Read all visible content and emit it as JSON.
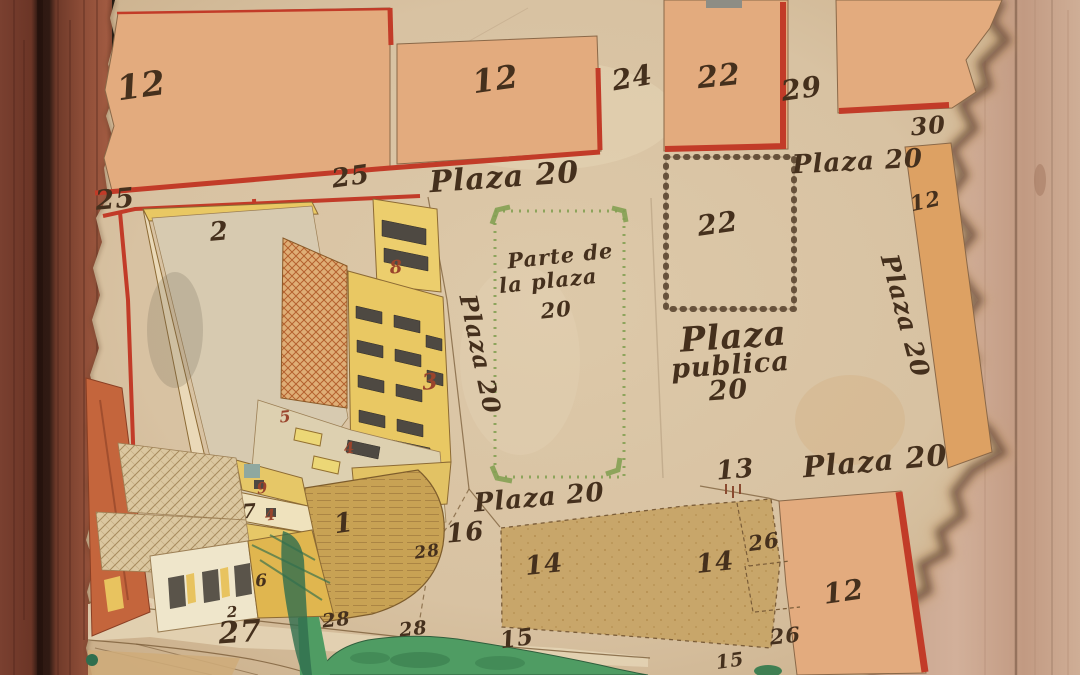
{
  "map": {
    "description_labels_note": "hand-drawn town plat on torn parchment",
    "plaza_block_names": [
      "Plaza 20",
      "Plaza publica 20",
      "Parte de la plaza 20"
    ]
  },
  "palette": {
    "parchment": "#d8c2a2",
    "parchment_light": "#e6d5b6",
    "salmon": "#e3ab7e",
    "red_line": "#c23b28",
    "tan_block": "#c8a66a",
    "khaki_wall": "#c8a254",
    "bldg_yellow": "#e9c863",
    "bldg_yellow_deep": "#e0b64f",
    "cream": "#efe6cb",
    "window_dark": "#4e4942",
    "green_border": "#84a053",
    "green_area": "#4f9c63",
    "green_dark": "#2f6e4e",
    "chain_brown": "#553f2a",
    "ink": "#45301d",
    "red_number": "#9a442c",
    "line_brown": "#7a5c38",
    "wood_frame": "#8a4733",
    "wood_frame_dark": "#5e2d1f",
    "wood_bg": "#cdab93",
    "orange_strip": "#dda163",
    "orange_bldg": "#c4653c",
    "burn": "#3d2413"
  },
  "labels": [
    {
      "name": "lot-12-top-left",
      "text": "12",
      "x": 143,
      "y": 97,
      "rot": -8,
      "size": 34,
      "cls": "ink"
    },
    {
      "name": "lot-25-left",
      "text": "25",
      "x": 116,
      "y": 208,
      "rot": -5,
      "size": 27,
      "cls": "ink"
    },
    {
      "name": "lot-25-mid",
      "text": "25",
      "x": 352,
      "y": 185,
      "rot": -8,
      "size": 26,
      "cls": "ink"
    },
    {
      "name": "lot-12-top-mid",
      "text": "12",
      "x": 497,
      "y": 90,
      "rot": -8,
      "size": 32,
      "cls": "ink"
    },
    {
      "name": "street-24",
      "text": "24",
      "x": 634,
      "y": 87,
      "rot": -10,
      "size": 28,
      "cls": "ink"
    },
    {
      "name": "plaza20-top",
      "text": "Plaza 20",
      "x": 505,
      "y": 187,
      "rot": -4,
      "size": 30,
      "cls": "ink"
    },
    {
      "name": "lot-22-top",
      "text": "22",
      "x": 720,
      "y": 86,
      "rot": -6,
      "size": 30,
      "cls": "ink"
    },
    {
      "name": "street-29",
      "text": "29",
      "x": 803,
      "y": 98,
      "rot": -8,
      "size": 28,
      "cls": "ink"
    },
    {
      "name": "lot-30",
      "text": "30",
      "x": 929,
      "y": 134,
      "rot": -5,
      "size": 24,
      "cls": "ink"
    },
    {
      "name": "plaza20-top-right",
      "text": "Plaza 20",
      "x": 858,
      "y": 170,
      "rot": -3,
      "size": 26,
      "cls": "ink"
    },
    {
      "name": "lot-12-right-strip",
      "text": "12",
      "x": 927,
      "y": 208,
      "rot": -12,
      "size": 21,
      "cls": "ink"
    },
    {
      "name": "plaza20-right-vertical",
      "text": "Plaza 20",
      "x": 897,
      "y": 318,
      "rot": 75,
      "size": 25,
      "cls": "ink"
    },
    {
      "name": "lot-22-chain-square",
      "text": "22",
      "x": 719,
      "y": 233,
      "rot": -8,
      "size": 28,
      "cls": "ink"
    },
    {
      "name": "plaza-publica-line1",
      "text": "Plaza",
      "x": 734,
      "y": 348,
      "rot": -4,
      "size": 34,
      "cls": "ink"
    },
    {
      "name": "plaza-publica-line2",
      "text": "publica",
      "x": 731,
      "y": 374,
      "rot": -4,
      "size": 27,
      "cls": "ink"
    },
    {
      "name": "plaza-publica-line3",
      "text": "20",
      "x": 729,
      "y": 399,
      "rot": -4,
      "size": 27,
      "cls": "ink"
    },
    {
      "name": "parte-plaza-line1",
      "text": "Parte de",
      "x": 561,
      "y": 263,
      "rot": -6,
      "size": 21,
      "cls": "ink"
    },
    {
      "name": "parte-plaza-line2",
      "text": "la plaza",
      "x": 549,
      "y": 288,
      "rot": -6,
      "size": 21,
      "cls": "ink"
    },
    {
      "name": "parte-plaza-line3",
      "text": "20",
      "x": 557,
      "y": 317,
      "rot": -6,
      "size": 21,
      "cls": "ink"
    },
    {
      "name": "plaza20-left-vertical",
      "text": "Plaza 20",
      "x": 472,
      "y": 356,
      "rot": 78,
      "size": 24,
      "cls": "ink"
    },
    {
      "name": "plaza20-center",
      "text": "Plaza 20",
      "x": 540,
      "y": 506,
      "rot": -5,
      "size": 26,
      "cls": "ink"
    },
    {
      "name": "plaza20-bottom-right",
      "text": "Plaza 20",
      "x": 876,
      "y": 471,
      "rot": -5,
      "size": 29,
      "cls": "ink"
    },
    {
      "name": "lot-13",
      "text": "13",
      "x": 736,
      "y": 478,
      "rot": -5,
      "size": 26,
      "cls": "ink"
    },
    {
      "name": "lot-16",
      "text": "16",
      "x": 466,
      "y": 541,
      "rot": -5,
      "size": 26,
      "cls": "ink"
    },
    {
      "name": "lot-14-left",
      "text": "14",
      "x": 545,
      "y": 573,
      "rot": -6,
      "size": 26,
      "cls": "ink"
    },
    {
      "name": "lot-14-right",
      "text": "14",
      "x": 716,
      "y": 571,
      "rot": -6,
      "size": 26,
      "cls": "ink"
    },
    {
      "name": "lot-26-upper",
      "text": "26",
      "x": 765,
      "y": 549,
      "rot": -8,
      "size": 21,
      "cls": "ink"
    },
    {
      "name": "lot-26-lower",
      "text": "26",
      "x": 786,
      "y": 643,
      "rot": -6,
      "size": 21,
      "cls": "ink"
    },
    {
      "name": "lot-12-bottom-right",
      "text": "12",
      "x": 845,
      "y": 601,
      "rot": -8,
      "size": 28,
      "cls": "ink"
    },
    {
      "name": "lot-15-left",
      "text": "15",
      "x": 518,
      "y": 646,
      "rot": -8,
      "size": 23,
      "cls": "ink"
    },
    {
      "name": "lot-15-right",
      "text": "15",
      "x": 731,
      "y": 667,
      "rot": -8,
      "size": 19,
      "cls": "ink"
    },
    {
      "name": "lot-27",
      "text": "27",
      "x": 241,
      "y": 642,
      "rot": -4,
      "size": 30,
      "cls": "ink"
    },
    {
      "name": "lot-28-a",
      "text": "28",
      "x": 428,
      "y": 557,
      "rot": -8,
      "size": 17,
      "cls": "ink"
    },
    {
      "name": "lot-28-b",
      "text": "28",
      "x": 337,
      "y": 626,
      "rot": -6,
      "size": 19,
      "cls": "ink"
    },
    {
      "name": "lot-28-c",
      "text": "28",
      "x": 414,
      "y": 635,
      "rot": -6,
      "size": 19,
      "cls": "ink"
    },
    {
      "name": "lot-2-yard",
      "text": "2",
      "x": 220,
      "y": 240,
      "rot": -5,
      "size": 26,
      "cls": "ink"
    },
    {
      "name": "building-8",
      "text": "8",
      "x": 397,
      "y": 273,
      "rot": -6,
      "size": 18,
      "cls": "red"
    },
    {
      "name": "building-3",
      "text": "3",
      "x": 431,
      "y": 389,
      "rot": -6,
      "size": 22,
      "cls": "red"
    },
    {
      "name": "building-5",
      "text": "5",
      "x": 286,
      "y": 422,
      "rot": -6,
      "size": 16,
      "cls": "red"
    },
    {
      "name": "building-4a",
      "text": "4",
      "x": 350,
      "y": 453,
      "rot": -6,
      "size": 15,
      "cls": "red"
    },
    {
      "name": "building-9",
      "text": "9",
      "x": 263,
      "y": 493,
      "rot": -6,
      "size": 15,
      "cls": "red"
    },
    {
      "name": "building-7",
      "text": "7",
      "x": 250,
      "y": 518,
      "rot": -4,
      "size": 20,
      "cls": "ink"
    },
    {
      "name": "building-4b",
      "text": "4",
      "x": 271,
      "y": 520,
      "rot": -6,
      "size": 15,
      "cls": "red"
    },
    {
      "name": "building-6",
      "text": "6",
      "x": 262,
      "y": 586,
      "rot": -4,
      "size": 17,
      "cls": "ink"
    },
    {
      "name": "building-2-small",
      "text": "2",
      "x": 233,
      "y": 617,
      "rot": -4,
      "size": 15,
      "cls": "ink"
    },
    {
      "name": "building-1",
      "text": "1",
      "x": 345,
      "y": 532,
      "rot": -8,
      "size": 27,
      "cls": "ink"
    }
  ]
}
